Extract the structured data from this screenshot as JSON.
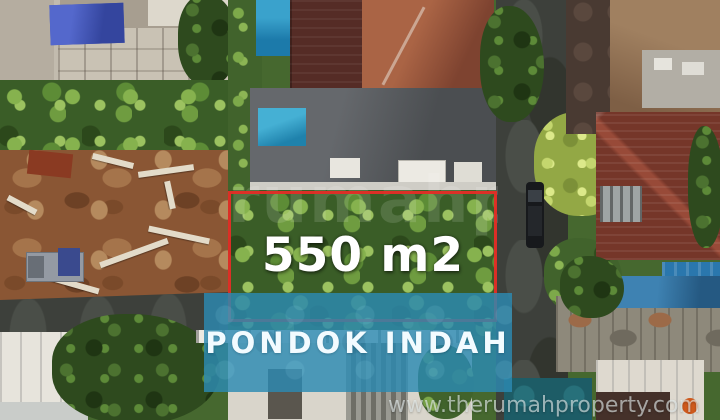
{
  "image": {
    "description": "Aerial drone photo of a vacant 550 m2 land plot outlined in red, located in Pondok Indah, surrounded by villas, swimming pools, a construction site and an access road",
    "width_px": 720,
    "height_px": 420
  },
  "overlays": {
    "area_label": "550 m2",
    "location_banner": "PONDOK INDAH",
    "website_watermark": "www.therumahproperty.com",
    "center_watermark": "rumahproperty",
    "colors": {
      "boundary_red": "#e42c26",
      "banner_blue": "#2c8ab2",
      "label_text": "#ffffff",
      "watermark_text": "#e9f1f1"
    }
  },
  "scene": {
    "regions": [
      "construction-house",
      "banana-grove",
      "dirt-lot",
      "truck",
      "terracotta-roof-house",
      "swimming-pool-top",
      "gray-roof-house",
      "swimming-pool-mid",
      "land-plot-vegetation",
      "access-road",
      "parked-car",
      "neighbor-tan-roof",
      "neighbor-maroon-roofs",
      "blue-awning",
      "shanty-roofs",
      "white-building",
      "teal-pool"
    ]
  }
}
